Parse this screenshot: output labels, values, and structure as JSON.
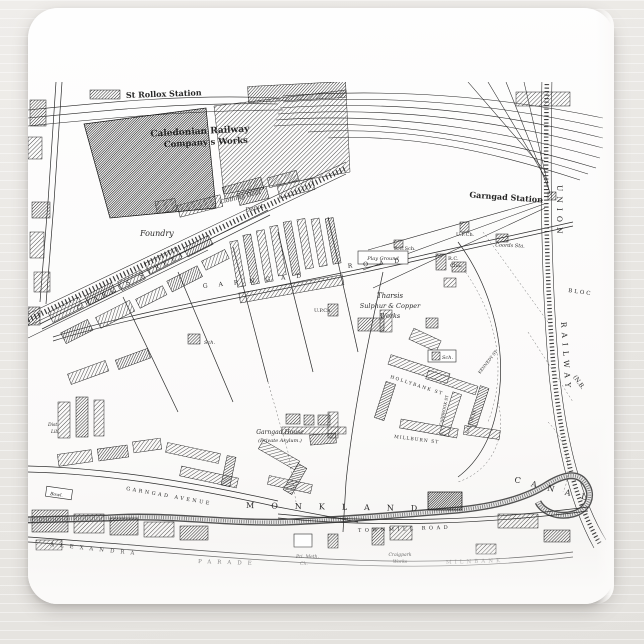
{
  "scene": {
    "description": "Product photo of a white mousepad printed with a vintage black-and-white Ordnance-Survey-style street map of the Garngad / St Rollox district of Glasgow, lying on a pale painted wood surface",
    "colors": {
      "background": "#e9e7e3",
      "pad": "#fbfaf9",
      "map_ink": "#1b1b1b",
      "shadow": "rgba(105,100,95,0.30)"
    }
  },
  "map": {
    "labels": {
      "st_rollox": "St Rollox Station",
      "caledonian_line1": "Caledonian Railway",
      "caledonian_line2": "Company's Works",
      "garngad_station": "Garngad Station",
      "union": "UNION",
      "railway": "RAILWAY",
      "nb": "(N.B.",
      "bloc": "BLOC",
      "foundry": "Foundry",
      "clothing_line1": "Clothing Dept",
      "clothing_line2": "Depot",
      "charles_street": "CHARLES STREET",
      "garngad_road_1": "GARNGAD",
      "garngad_road_2": "ROAD",
      "play_ground": "Play Ground",
      "rc_sch": "R.C.Sch.",
      "uf_ch": "U.F.Ch.",
      "coords_sta": "Coords Sta.",
      "rc_cha_line1": "R.C.",
      "rc_cha_line2": "Cha.",
      "tharsis_line1": "Tharsis",
      "tharsis_line2": "Sulphur & Copper",
      "tharsis_line3": "Works",
      "up_ch": "U.P.Ch.",
      "sch_west": "Sch.",
      "sch_east": "Sch.",
      "hollybank_st": "HOLLYBANK ST",
      "millburn_st": "MILLBURN ST",
      "carbrook_st": "CARBROOK ST",
      "dalton_st": "DALTON ST",
      "kennedy_st": "KENNEDY ST",
      "garngad_house_line1": "Garngad House",
      "garngad_house_line2": "(Private Asylum.)",
      "garngad_avenue": "GARNGAD AVENUE",
      "dist_lib_line1": "Dist.",
      "dist_lib_line2": "Lib.",
      "bowl": "Bowl.",
      "monkland": "MONKLAND",
      "canal": "CANAL",
      "townmill_road": "TOWNMILL ROAD",
      "alexandra": "ALEXANDRA",
      "parade": "PARADE",
      "pri_meth_line1": "Pri. Meth.",
      "pri_meth_line2": "Ch.",
      "craigpark_line1": "Craigpark",
      "craigpark_line2": "Works",
      "milnbank": "MILNBANK"
    }
  }
}
